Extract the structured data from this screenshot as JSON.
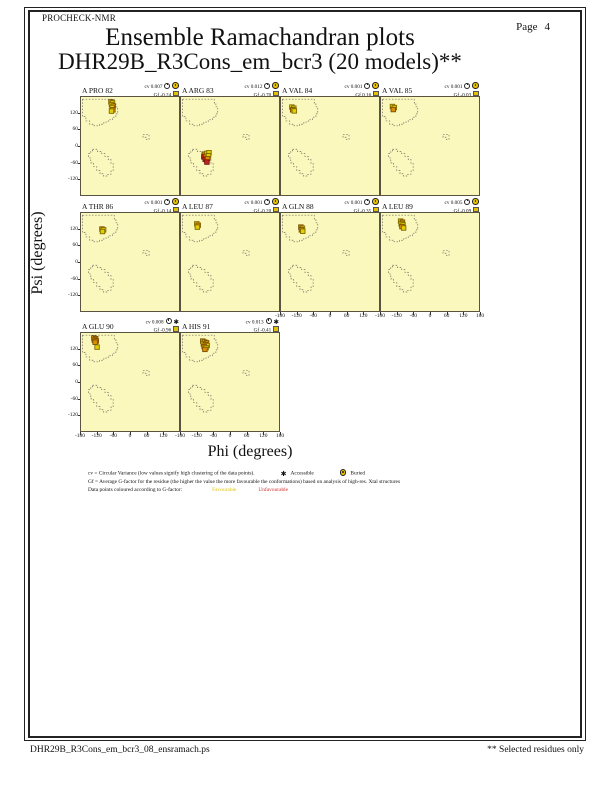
{
  "header": {
    "app_name": "PROCHECK-NMR",
    "page_label": "Page",
    "page_number": "4",
    "title": "Ensemble Ramachandran plots",
    "subtitle": "DHR29B_R3Cons_em_bcr3 (20 models)**"
  },
  "labels": {
    "cv": "cv",
    "gf": "Gf"
  },
  "colors": {
    "plot_background": "#FBF8BE",
    "grade_fill": {
      "fav": "#E3CE00",
      "mid": "#DD8F00",
      "unf": "#C3231C"
    },
    "grade_stroke": {
      "fav": "#7d6a00",
      "mid": "#7a4c00",
      "unf": "#6e1410"
    },
    "region_line": "#6e6e5e",
    "favourable_text": "#E0C400",
    "unfavourable_text": "#D03030"
  },
  "legend": {
    "cv_line": "cv = Circular Variance (low values signify high clustering of the data points).",
    "accessible": "Accessible",
    "buried": "Buried",
    "gf_line": "Gf = Average G-factor for the residue (the higher the value the more favourable the conformations) based on analysis of high-res. Xtal structures",
    "colour_line": "Data points coloured according to G-factor:",
    "favourable": "Favourable",
    "unfavourable": "Unfavourable"
  },
  "footer": {
    "left": "DHR29B_R3Cons_em_bcr3_08_ensramach.ps",
    "right": "** Selected residues only"
  },
  "chart_data": {
    "type": "scatter",
    "xlabel": "Phi (degrees)",
    "ylabel": "Psi (degrees)",
    "xlim": [
      -180,
      180
    ],
    "ylim": [
      -180,
      180
    ],
    "x_ticks": [
      -180,
      -120,
      -60,
      0,
      60,
      120,
      180
    ],
    "y_ticks": [
      120,
      60,
      0,
      -60,
      -120
    ],
    "grid": false,
    "point_grades": {
      "fav": "Favourable",
      "mid": "Intermediate",
      "unf": "Unfavourable"
    },
    "plots": [
      {
        "residue": "A PRO 82",
        "cv": "0.007",
        "gf": "-0.24",
        "accessibility": "Buried",
        "points": [
          [
            -70,
            162,
            "mid"
          ],
          [
            -64,
            158,
            "fav"
          ],
          [
            -68,
            152,
            "fav"
          ],
          [
            -62,
            147,
            "mid"
          ],
          [
            -66,
            141,
            "fav"
          ],
          [
            -63,
            133,
            "mid"
          ],
          [
            -68,
            128,
            "fav"
          ]
        ]
      },
      {
        "residue": "A ARG 83",
        "cv": "0.012",
        "gf": "-0.70",
        "accessibility": "Buried",
        "points": [
          [
            -94,
            -30,
            "mid"
          ],
          [
            -85,
            -27,
            "fav"
          ],
          [
            -77,
            -25,
            "fav"
          ],
          [
            -96,
            -40,
            "unf"
          ],
          [
            -88,
            -38,
            "mid"
          ],
          [
            -79,
            -36,
            "fav"
          ],
          [
            -91,
            -49,
            "unf"
          ],
          [
            -82,
            -47,
            "mid"
          ],
          [
            -85,
            -59,
            "unf"
          ]
        ]
      },
      {
        "residue": "A VAL 84",
        "cv": "0.001",
        "gf": "0.16",
        "accessibility": "Buried",
        "points": [
          [
            -140,
            143,
            "fav"
          ],
          [
            -133,
            139,
            "fav"
          ],
          [
            -137,
            133,
            "mid"
          ],
          [
            -131,
            129,
            "fav"
          ]
        ]
      },
      {
        "residue": "A VAL 85",
        "cv": "0.001",
        "gf": "-0.03",
        "accessibility": "Buried",
        "points": [
          [
            -138,
            145,
            "fav"
          ],
          [
            -131,
            141,
            "fav"
          ],
          [
            -135,
            134,
            "mid"
          ]
        ]
      },
      {
        "residue": "A THR 86",
        "cv": "0.001",
        "gf": "-0.14",
        "accessibility": "Buried",
        "points": [
          [
            -103,
            121,
            "mid"
          ],
          [
            -97,
            118,
            "fav"
          ],
          [
            -101,
            112,
            "fav"
          ]
        ]
      },
      {
        "residue": "A LEU 87",
        "cv": "0.001",
        "gf": "-0.20",
        "accessibility": "Buried",
        "points": [
          [
            -122,
            140,
            "fav"
          ],
          [
            -117,
            135,
            "mid"
          ],
          [
            -120,
            128,
            "fav"
          ]
        ]
      },
      {
        "residue": "A GLN 88",
        "cv": "0.001",
        "gf": "-0.35",
        "accessibility": "Buried",
        "points": [
          [
            -107,
            128,
            "mid"
          ],
          [
            -101,
            124,
            "fav"
          ],
          [
            -105,
            118,
            "mid"
          ],
          [
            -100,
            113,
            "fav"
          ]
        ]
      },
      {
        "residue": "A LEU 89",
        "cv": "0.005",
        "gf": "-0.09",
        "accessibility": "Buried",
        "points": [
          [
            -108,
            150,
            "fav"
          ],
          [
            -101,
            146,
            "mid"
          ],
          [
            -106,
            140,
            "fav"
          ],
          [
            -99,
            136,
            "fav"
          ],
          [
            -103,
            130,
            "mid"
          ],
          [
            -97,
            125,
            "fav"
          ]
        ]
      },
      {
        "residue": "A GLU 90",
        "cv": "0.008",
        "gf": "-0.96",
        "accessibility": "Accessible",
        "points": [
          [
            -133,
            162,
            "mid"
          ],
          [
            -126,
            159,
            "mid"
          ],
          [
            -131,
            154,
            "mid"
          ],
          [
            -124,
            151,
            "mid"
          ],
          [
            -128,
            146,
            "mid"
          ],
          [
            -121,
            128,
            "fav"
          ]
        ]
      },
      {
        "residue": "A HIS 91",
        "cv": "0.013",
        "gf": "-0.41",
        "accessibility": "Accessible",
        "points": [
          [
            -100,
            150,
            "mid"
          ],
          [
            -93,
            147,
            "fav"
          ],
          [
            -86,
            144,
            "mid"
          ],
          [
            -98,
            140,
            "fav"
          ],
          [
            -91,
            137,
            "mid"
          ],
          [
            -84,
            134,
            "fav"
          ],
          [
            -95,
            130,
            "mid"
          ],
          [
            -88,
            126,
            "fav"
          ],
          [
            -92,
            120,
            "mid"
          ]
        ]
      }
    ]
  }
}
